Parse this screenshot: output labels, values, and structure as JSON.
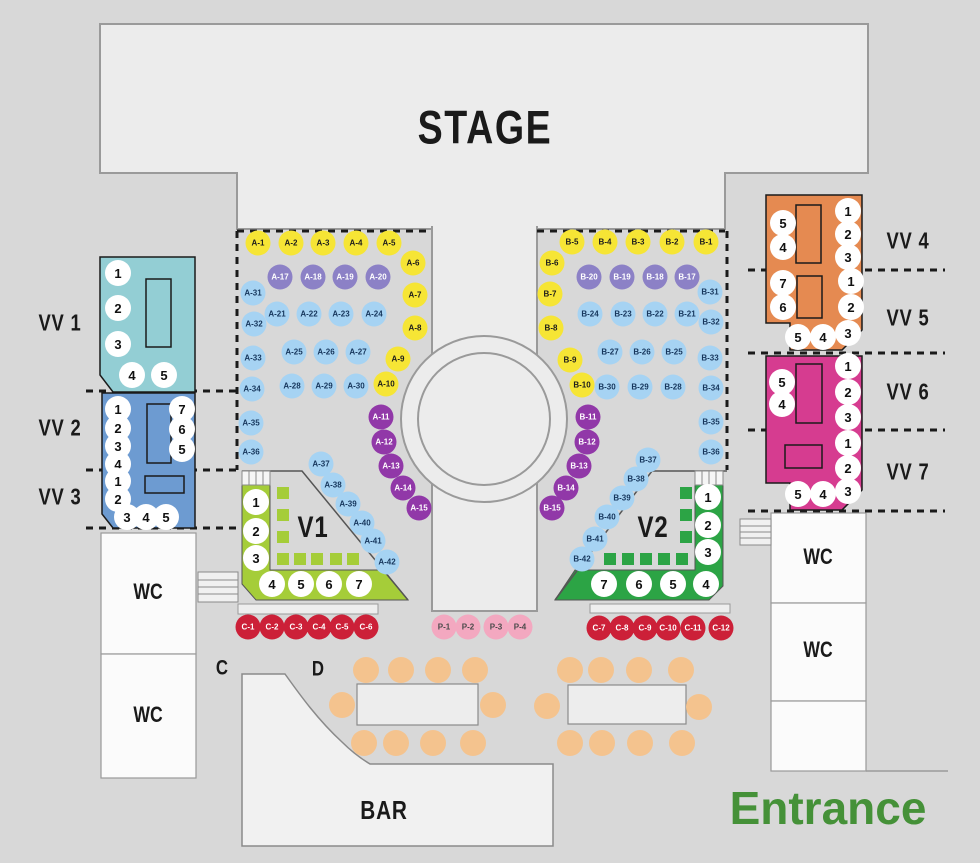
{
  "areas": {
    "stage": "STAGE",
    "wc": "WC",
    "bar": "BAR",
    "entrance": "Entrance",
    "row_c_label": "C",
    "row_d_label": "D"
  },
  "sections": {
    "vv1": {
      "label": "VV 1",
      "seats": [
        [
          "1",
          118,
          273
        ],
        [
          "2",
          118,
          308
        ],
        [
          "3",
          118,
          344
        ],
        [
          "4",
          132,
          375
        ],
        [
          "5",
          164,
          375
        ]
      ]
    },
    "vv2": {
      "label": "VV 2",
      "seats": [
        [
          "1",
          118,
          409
        ],
        [
          "2",
          118,
          428
        ],
        [
          "3",
          118,
          446
        ],
        [
          "4",
          118,
          464
        ],
        [
          "7",
          182,
          409
        ],
        [
          "6",
          182,
          429
        ],
        [
          "5",
          182,
          449
        ]
      ]
    },
    "vv3": {
      "label": "VV 3",
      "seats": [
        [
          "1",
          118,
          481
        ],
        [
          "2",
          118,
          499
        ],
        [
          "3",
          127,
          517
        ],
        [
          "4",
          146,
          517
        ],
        [
          "5",
          166,
          517
        ]
      ]
    },
    "vv4": {
      "label": "VV 4",
      "seats": [
        [
          "5",
          783,
          223
        ],
        [
          "4",
          783,
          247
        ],
        [
          "1",
          848,
          211
        ],
        [
          "2",
          848,
          234
        ],
        [
          "3",
          848,
          257
        ]
      ]
    },
    "vv5": {
      "label": "VV 5",
      "seats": [
        [
          "7",
          783,
          283
        ],
        [
          "6",
          783,
          307
        ],
        [
          "1",
          851,
          281
        ],
        [
          "2",
          851,
          307
        ],
        [
          "5",
          798,
          337
        ],
        [
          "4",
          823,
          337
        ],
        [
          "3",
          848,
          333
        ]
      ]
    },
    "vv6": {
      "label": "VV 6",
      "seats": [
        [
          "5",
          782,
          382
        ],
        [
          "4",
          782,
          404
        ],
        [
          "1",
          848,
          366
        ],
        [
          "2",
          848,
          392
        ],
        [
          "3",
          848,
          417
        ]
      ]
    },
    "vv7": {
      "label": "VV 7",
      "seats": [
        [
          "1",
          848,
          443
        ],
        [
          "2",
          848,
          468
        ],
        [
          "5",
          798,
          494
        ],
        [
          "4",
          823,
          494
        ],
        [
          "3",
          848,
          491
        ]
      ]
    },
    "v1": {
      "label": "V1",
      "seats": [
        [
          "1",
          256,
          502
        ],
        [
          "2",
          256,
          531
        ],
        [
          "3",
          256,
          558
        ],
        [
          "4",
          272,
          584
        ],
        [
          "5",
          301,
          584
        ],
        [
          "6",
          329,
          584
        ],
        [
          "7",
          359,
          584
        ]
      ]
    },
    "v2": {
      "label": "V2",
      "seats": [
        [
          "1",
          708,
          497
        ],
        [
          "2",
          708,
          525
        ],
        [
          "3",
          708,
          552
        ],
        [
          "7",
          604,
          584
        ],
        [
          "6",
          639,
          584
        ],
        [
          "5",
          673,
          584
        ],
        [
          "4",
          706,
          584
        ]
      ]
    }
  },
  "seats": {
    "a": [
      [
        "A-1",
        258,
        243,
        "y"
      ],
      [
        "A-2",
        291,
        243,
        "y"
      ],
      [
        "A-3",
        323,
        243,
        "y"
      ],
      [
        "A-4",
        356,
        243,
        "y"
      ],
      [
        "A-5",
        389,
        243,
        "y"
      ],
      [
        "A-6",
        413,
        263,
        "y"
      ],
      [
        "A-7",
        415,
        295,
        "y"
      ],
      [
        "A-8",
        415,
        328,
        "y"
      ],
      [
        "A-9",
        398,
        359,
        "y"
      ],
      [
        "A-10",
        386,
        384,
        "y"
      ],
      [
        "A-17",
        280,
        277,
        "p"
      ],
      [
        "A-18",
        313,
        277,
        "p"
      ],
      [
        "A-19",
        345,
        277,
        "p"
      ],
      [
        "A-20",
        378,
        277,
        "p"
      ],
      [
        "A-31",
        253,
        293,
        "b"
      ],
      [
        "A-21",
        277,
        314,
        "b"
      ],
      [
        "A-22",
        309,
        314,
        "b"
      ],
      [
        "A-23",
        341,
        314,
        "b"
      ],
      [
        "A-24",
        374,
        314,
        "b"
      ],
      [
        "A-32",
        254,
        324,
        "b"
      ],
      [
        "A-25",
        294,
        352,
        "b"
      ],
      [
        "A-26",
        326,
        352,
        "b"
      ],
      [
        "A-27",
        358,
        352,
        "b"
      ],
      [
        "A-33",
        253,
        358,
        "b"
      ],
      [
        "A-28",
        292,
        386,
        "b"
      ],
      [
        "A-29",
        324,
        386,
        "b"
      ],
      [
        "A-30",
        356,
        386,
        "b"
      ],
      [
        "A-34",
        252,
        389,
        "b"
      ],
      [
        "A-35",
        251,
        423,
        "b"
      ],
      [
        "A-36",
        251,
        452,
        "b"
      ],
      [
        "A-37",
        321,
        464,
        "b"
      ],
      [
        "A-38",
        333,
        485,
        "b"
      ],
      [
        "A-39",
        348,
        504,
        "b"
      ],
      [
        "A-40",
        362,
        523,
        "b"
      ],
      [
        "A-41",
        373,
        541,
        "b"
      ],
      [
        "A-42",
        387,
        562,
        "b"
      ],
      [
        "A-11",
        381,
        417,
        "v"
      ],
      [
        "A-12",
        384,
        442,
        "v"
      ],
      [
        "A-13",
        391,
        466,
        "v"
      ],
      [
        "A-14",
        403,
        488,
        "v"
      ],
      [
        "A-15",
        419,
        508,
        "v"
      ]
    ],
    "b": [
      [
        "B-5",
        572,
        242,
        "y"
      ],
      [
        "B-4",
        605,
        242,
        "y"
      ],
      [
        "B-3",
        638,
        242,
        "y"
      ],
      [
        "B-2",
        672,
        242,
        "y"
      ],
      [
        "B-1",
        706,
        242,
        "y"
      ],
      [
        "B-6",
        552,
        263,
        "y"
      ],
      [
        "B-7",
        550,
        294,
        "y"
      ],
      [
        "B-8",
        551,
        328,
        "y"
      ],
      [
        "B-9",
        570,
        360,
        "y"
      ],
      [
        "B-10",
        582,
        385,
        "y"
      ],
      [
        "B-20",
        589,
        277,
        "p"
      ],
      [
        "B-19",
        622,
        277,
        "p"
      ],
      [
        "B-18",
        655,
        277,
        "p"
      ],
      [
        "B-17",
        687,
        277,
        "p"
      ],
      [
        "B-31",
        710,
        292,
        "b"
      ],
      [
        "B-24",
        590,
        314,
        "b"
      ],
      [
        "B-23",
        623,
        314,
        "b"
      ],
      [
        "B-22",
        655,
        314,
        "b"
      ],
      [
        "B-21",
        687,
        314,
        "b"
      ],
      [
        "B-32",
        711,
        322,
        "b"
      ],
      [
        "B-27",
        610,
        352,
        "b"
      ],
      [
        "B-26",
        642,
        352,
        "b"
      ],
      [
        "B-25",
        674,
        352,
        "b"
      ],
      [
        "B-33",
        710,
        358,
        "b"
      ],
      [
        "B-30",
        607,
        387,
        "b"
      ],
      [
        "B-29",
        640,
        387,
        "b"
      ],
      [
        "B-28",
        673,
        387,
        "b"
      ],
      [
        "B-34",
        711,
        388,
        "b"
      ],
      [
        "B-35",
        711,
        422,
        "b"
      ],
      [
        "B-36",
        711,
        452,
        "b"
      ],
      [
        "B-37",
        648,
        460,
        "b"
      ],
      [
        "B-38",
        636,
        479,
        "b"
      ],
      [
        "B-39",
        622,
        498,
        "b"
      ],
      [
        "B-40",
        607,
        517,
        "b"
      ],
      [
        "B-41",
        595,
        539,
        "b"
      ],
      [
        "B-42",
        582,
        559,
        "b"
      ],
      [
        "B-11",
        588,
        417,
        "v"
      ],
      [
        "B-12",
        587,
        442,
        "v"
      ],
      [
        "B-13",
        579,
        466,
        "v"
      ],
      [
        "B-14",
        566,
        488,
        "v"
      ],
      [
        "B-15",
        552,
        508,
        "v"
      ]
    ],
    "c_row": [
      [
        "C-1",
        248,
        627
      ],
      [
        "C-2",
        272,
        627
      ],
      [
        "C-3",
        296,
        627
      ],
      [
        "C-4",
        319,
        627
      ],
      [
        "C-5",
        342,
        627
      ],
      [
        "C-6",
        366,
        627
      ],
      [
        "C-7",
        599,
        628
      ],
      [
        "C-8",
        622,
        628
      ],
      [
        "C-9",
        645,
        628
      ],
      [
        "C-10",
        668,
        628
      ],
      [
        "C-11",
        693,
        628
      ],
      [
        "C-12",
        721,
        628
      ]
    ],
    "p_row": [
      [
        "P-1",
        444,
        627
      ],
      [
        "P-2",
        468,
        627
      ],
      [
        "P-3",
        496,
        627
      ],
      [
        "P-4",
        520,
        627
      ]
    ]
  },
  "stools": [
    [
      366,
      670
    ],
    [
      401,
      670
    ],
    [
      438,
      670
    ],
    [
      475,
      670
    ],
    [
      342,
      705
    ],
    [
      493,
      705
    ],
    [
      364,
      743
    ],
    [
      396,
      743
    ],
    [
      433,
      743
    ],
    [
      473,
      743
    ],
    [
      570,
      670
    ],
    [
      601,
      670
    ],
    [
      639,
      670
    ],
    [
      681,
      670
    ],
    [
      547,
      706
    ],
    [
      699,
      707
    ],
    [
      570,
      743
    ],
    [
      602,
      743
    ],
    [
      640,
      743
    ],
    [
      682,
      743
    ]
  ],
  "colors": {
    "bg": "#d8d8d8",
    "stage_fill": "#ececec",
    "stage_border": "#9a9a9a",
    "seat_yellow": "#f6e535",
    "seat_blue": "#a6d3f3",
    "seat_purple": "#8c81c6",
    "seat_violet": "#9138a8",
    "seat_red": "#cc2038",
    "seat_pink": "#f3a8c0",
    "stool_orange": "#f4c38e",
    "vv1_teal": "#93ced4",
    "vv23_blue": "#6d9bd1",
    "vv45_orange": "#e58a51",
    "vv67_magenta": "#d63c90",
    "v1_green": "#a5cd39",
    "v2_green": "#2ca445",
    "entrance_green": "#459138",
    "line_dark": "#1a1a1a"
  }
}
